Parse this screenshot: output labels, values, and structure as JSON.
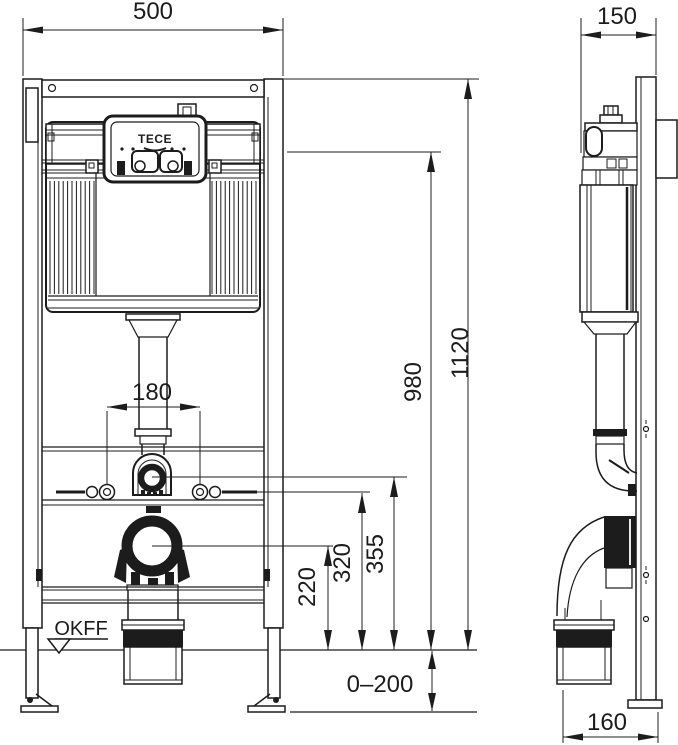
{
  "brand_logo": "TECE",
  "floor_label": "OKFF",
  "dims": {
    "frame_width": "500",
    "frame_depth": "150",
    "frame_height": "1120",
    "panel_height": "980",
    "flush_bend_height": "355",
    "fixing_height": "320",
    "outlet_height": "220",
    "stud_spacing": "180",
    "leg_adjustment": "0–200",
    "outlet_depth": "160"
  }
}
